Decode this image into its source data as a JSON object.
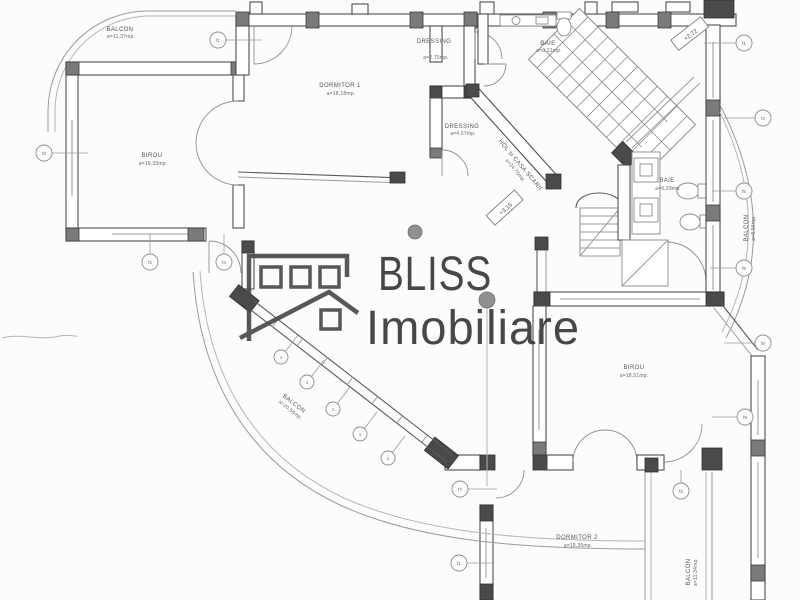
{
  "watermark": {
    "brand": "BLISS",
    "sub": "Imobiliare"
  },
  "rooms": [
    {
      "name": "BALCON",
      "area": "a=11,37mp."
    },
    {
      "name": "DORMITOR 1",
      "area": "a=18,18mp."
    },
    {
      "name": "DRESSING",
      "area": "a=2,75mp."
    },
    {
      "name": "BAIE",
      "area": "a=8,21mp."
    },
    {
      "name": "DRESSING",
      "area": "a=4,57mp."
    },
    {
      "name": "HOL si CASA SCARII",
      "area": "a=24,76mp."
    },
    {
      "name": "BIROU",
      "area": "a=19,33mp."
    },
    {
      "name": "BAIE",
      "area": "a=6,29mp."
    },
    {
      "name": "BALCON",
      "area": "a=8,56mp."
    },
    {
      "name": "BIROU",
      "area": "a=18,51mp."
    },
    {
      "name": "BALCON",
      "area": "a=20,56mp."
    },
    {
      "name": "DORMITOR 2",
      "area": "a=19,35mp."
    },
    {
      "name": "BALCON",
      "area": "a=11,34mp."
    }
  ],
  "levels": [
    {
      "label": "+3,15"
    },
    {
      "label": "+2,72"
    }
  ],
  "markers": [
    {
      "label": "f1"
    },
    {
      "label": "f3"
    },
    {
      "label": "f2"
    },
    {
      "label": "f4"
    },
    {
      "label": "f1"
    },
    {
      "label": "f2"
    },
    {
      "label": "f5"
    },
    {
      "label": "f6"
    },
    {
      "label": "f8"
    },
    {
      "label": "f9"
    },
    {
      "label": "f7"
    },
    {
      "label": "f1"
    },
    {
      "label": "f2"
    },
    {
      "label": "1"
    },
    {
      "label": "1"
    },
    {
      "label": "1"
    },
    {
      "label": "1"
    },
    {
      "label": "1"
    }
  ],
  "colors": {
    "paper": "#fcfcfc",
    "line": "#8f8f8f",
    "wall": "#4e4e4e",
    "logo": "#383838"
  }
}
